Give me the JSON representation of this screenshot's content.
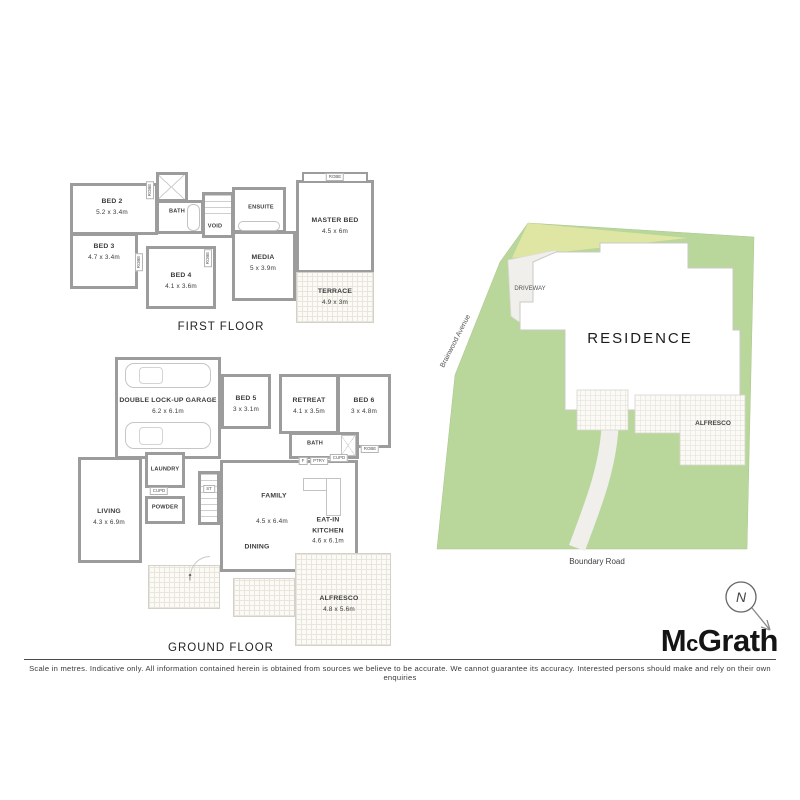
{
  "first_floor": {
    "title": "FIRST FLOOR",
    "rooms": {
      "bed2": {
        "name": "BED 2",
        "dims": "5.2 x 3.4m"
      },
      "bed3": {
        "name": "BED 3",
        "dims": "4.7 x 3.4m"
      },
      "bed4": {
        "name": "BED 4",
        "dims": "4.1 x 3.6m"
      },
      "bath": {
        "name": "BATH"
      },
      "void": {
        "name": "VOID"
      },
      "ensuite": {
        "name": "ENSUITE"
      },
      "media": {
        "name": "MEDIA",
        "dims": "5 x 3.9m"
      },
      "master": {
        "name": "MASTER BED",
        "dims": "4.5 x 6m"
      },
      "terrace": {
        "name": "TERRACE",
        "dims": "4.9 x 3m"
      }
    }
  },
  "ground_floor": {
    "title": "GROUND FLOOR",
    "rooms": {
      "garage": {
        "name": "DOUBLE LOCK-UP GARAGE",
        "dims": "6.2 x 6.1m"
      },
      "bed5": {
        "name": "BED 5",
        "dims": "3 x 3.1m"
      },
      "retreat": {
        "name": "RETREAT",
        "dims": "4.1 x 3.5m"
      },
      "bed6": {
        "name": "BED 6",
        "dims": "3 x 4.8m"
      },
      "bath": {
        "name": "BATH"
      },
      "laundry": {
        "name": "LAUNDRY"
      },
      "powder": {
        "name": "POWDER"
      },
      "stairs": {
        "name": "ST"
      },
      "living": {
        "name": "LIVING",
        "dims": "4.3 x 6.9m"
      },
      "family": {
        "name": "FAMILY",
        "dims": "4.5 x 6.4m"
      },
      "kitchen": {
        "line1": "EAT-IN",
        "line2": "KITCHEN",
        "dims": "4.6 x 6.1m"
      },
      "dining": {
        "name": "DINING"
      },
      "alfresco": {
        "name": "ALFRESCO",
        "dims": "4.8 x 5.6m"
      }
    }
  },
  "labels": {
    "robe": "ROBE",
    "cupd": "CUPD",
    "ptry": "PTRY",
    "fridge": "F"
  },
  "site": {
    "residence": "RESIDENCE",
    "driveway": "DRIVEWAY",
    "alfresco": "ALFRESCO",
    "street_left": "Brainwood Avenue",
    "street_bottom": "Boundary Road",
    "north": "N",
    "colors": {
      "land": "#b9d69b",
      "verge": "#dfe5a2",
      "paving": "#f0efec"
    }
  },
  "brand": {
    "m": "M",
    "c": "c",
    "rest": "Grath"
  },
  "footer": {
    "disclaimer": "Scale in metres. Indicative only. All information contained herein is obtained from sources we believe to be accurate. We cannot guarantee its accuracy. Interested persons should make and rely on their own enquiries"
  }
}
